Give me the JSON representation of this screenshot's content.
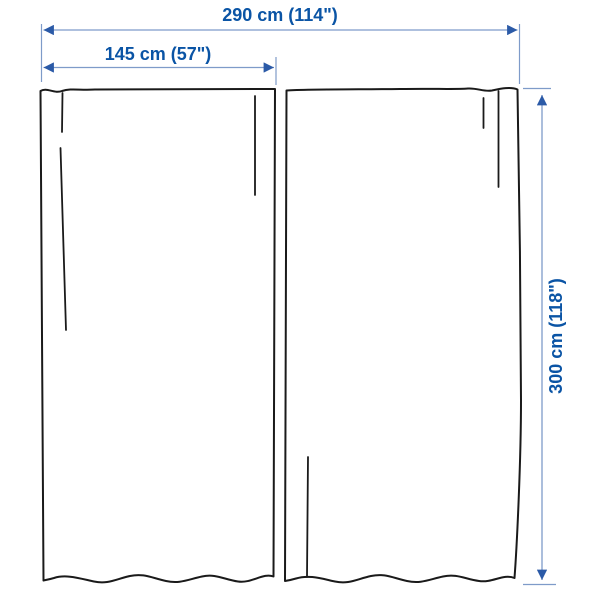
{
  "diagram": {
    "kind": "product-dimension-diagram",
    "labels": {
      "total_width": "290 cm (114\")",
      "panel_width": "145 cm (57\")",
      "height": "300 cm (118\")"
    }
  },
  "colors": {
    "dimension_text": "#0a54a5",
    "dimension_line": "#7e9bc9",
    "arrowhead": "#2b5aa7",
    "outline": "#1a1a1a",
    "background": "#ffffff"
  }
}
